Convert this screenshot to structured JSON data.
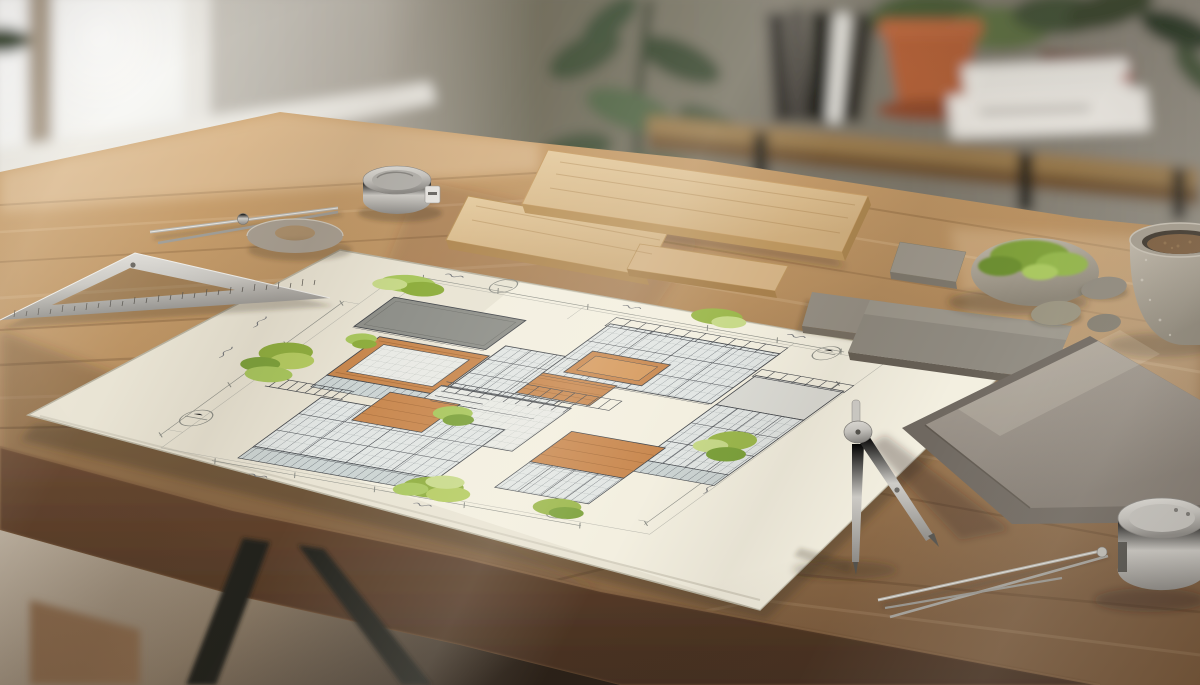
{
  "meta": {
    "description": "Sunlit wooden architect desk with a hand-drawn isometric architectural concept sketch on cream paper, surrounded by drafting tools and material samples; bright window at left, taupe wall and a console shelf with books and a terracotta potted plant behind."
  },
  "palette": {
    "wall": "#7d786c",
    "wallLight": "#d6d3cc",
    "window": "#f7f7f4",
    "sill": "#eceae4",
    "plant": "#46553c",
    "shelfWood": "#997a4e",
    "shelfFront": "#6f5233",
    "metalLeg": "#23201c",
    "bookDark": "#2e2b26",
    "bookWhite": "#e9e7e1",
    "terracotta": "#b06038",
    "desk": "#b78f60",
    "deskLit": "#cfa673",
    "deskDark": "#7c5c3e",
    "deskFront": "#5d4230",
    "floor": "#c0b4a3",
    "paper": "#e9e4d4",
    "ink": "#45484d",
    "glass": "#e2e6e4",
    "mullion": "#6b7077",
    "slab": "#dcdcd6",
    "slabDark": "#8f908a",
    "woodAccent": "#c9884f",
    "green": "#9cb84d",
    "greenLight": "#c8da8a",
    "greenDark": "#7da23c",
    "metal": "#c9c7c2",
    "metalDark": "#8e8c88",
    "stone": "#9a948a",
    "stoneDark": "#746d62",
    "tile": "#9d968d",
    "moss": "#8aa73f",
    "pebble": "#8f887c",
    "bowl": "#b5aca0",
    "bowlContents": "#7b5c3d"
  },
  "scene": {
    "background": {
      "window_label": "bright frosted window, left",
      "wall_label": "taupe wall",
      "plant_label": "blurred houseplant",
      "console_label": "wood console shelf with black legs",
      "console_items": [
        "leaning dark books",
        "terracotta potted plant on saucer",
        "two stacked white books"
      ]
    },
    "desk_label": "oak desk on black trestle legs",
    "blueprint": {
      "label": "hand-drawn isometric concept sketch of a flat-roofed villa with roof terraces",
      "elements": [
        "glass skylight roof grids",
        "wood planter boxes and decks",
        "green shrub clusters",
        "courtyard stair",
        "dimension lines with ticks",
        "grid bubble circles",
        "illegible handwritten notes"
      ]
    },
    "tools": [
      "steel set square with ruler ticks",
      "divider caliper",
      "metal washer ring",
      "small tape measure",
      "standing drafting compass",
      "divider needles",
      "large tape measure"
    ],
    "samples": [
      "three wood planks",
      "three small stone tiles",
      "stacked large porcelain tiles",
      "moss-covered stone",
      "pebbles",
      "stone bowl with aggregate"
    ]
  }
}
